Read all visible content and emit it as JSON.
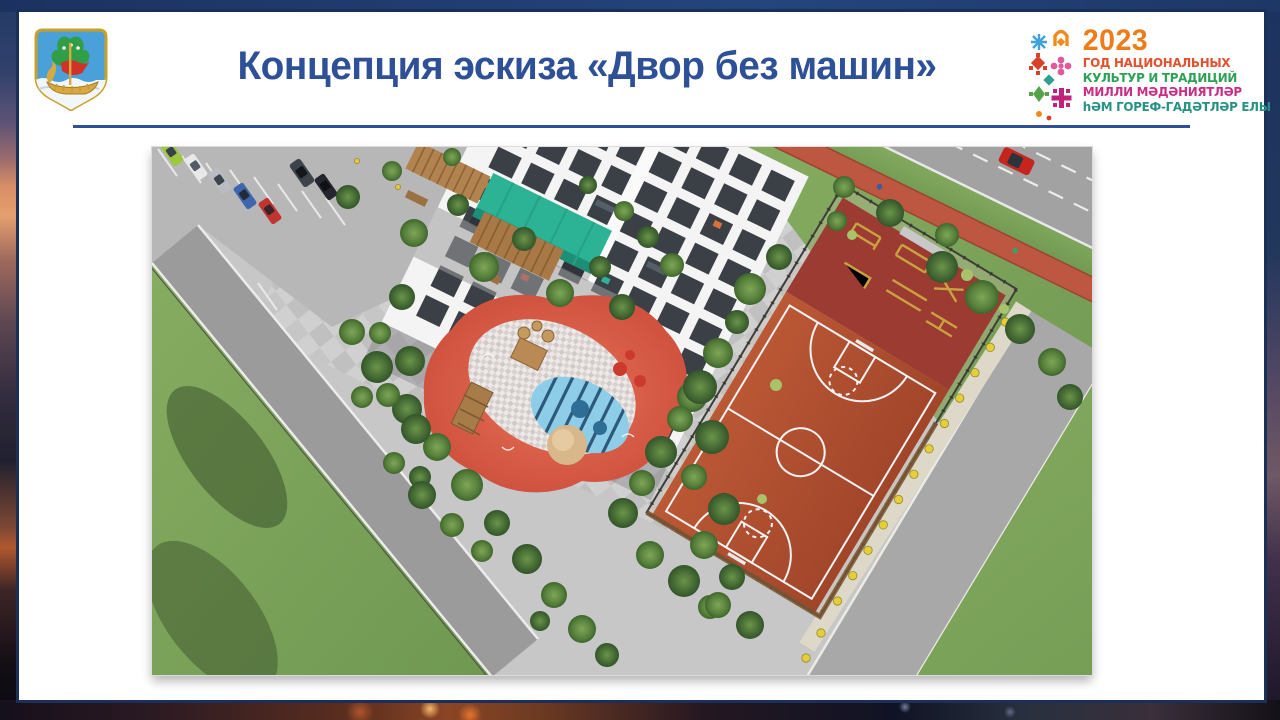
{
  "header": {
    "title": "Концепция эскиза «Двор без машин»"
  },
  "year_badge": {
    "year": "2023",
    "lines": [
      {
        "text": "ГОД НАЦИОНАЛЬНЫХ",
        "color": "#e1512e"
      },
      {
        "text": "КУЛЬТУР И ТРАДИЦИЙ",
        "color": "#2fa156"
      },
      {
        "text": "МИЛЛИ МӘДӘНИЯТЛӘР",
        "color": "#c92d85"
      },
      {
        "text": "һӘМ ГОРЕФ-ГАДӘТЛӘР ЕЛЫ",
        "color": "#279184"
      }
    ]
  },
  "colors": {
    "title_blue": "#2d5096",
    "rule_blue": "#2d5096",
    "year_orange": "#ee7c1b",
    "canopy_teal": "#2cb294",
    "court_terracotta": "#b14f2e",
    "workout_maroon": "#9c3b32",
    "bike_lane_red": "#bd5742",
    "lawn_green": "#7ba35a",
    "road_gray": "#a2a2a2",
    "asphalt_gray": "#c7c7c7",
    "playground_coral": "#e06a50",
    "pool_blue": "#8ecde8",
    "sand_beige": "#d8b88a",
    "emblem_sky": "#4aa0d8",
    "emblem_gold": "#c9a127",
    "emblem_green": "#2f9e47",
    "emblem_red": "#d03227",
    "boat_gold": "#d8a93f"
  }
}
